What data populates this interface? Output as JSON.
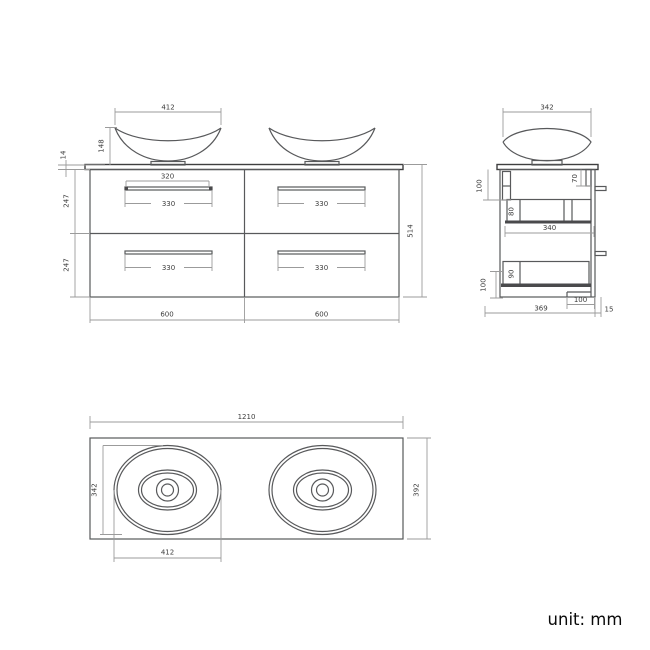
{
  "front_view": {
    "basin_width": "412",
    "basin_height": "148",
    "countertop_thickness": "14",
    "drawer_row_top_height": "247",
    "drawer_row_bottom_height": "247",
    "total_height": "514",
    "left_cabinet_width": "600",
    "right_cabinet_width": "600",
    "handle_span": "320",
    "handle_width_tl": "330",
    "handle_width_tr": "330",
    "handle_width_bl": "330",
    "handle_width_br": "330"
  },
  "side_view": {
    "basin_depth": "342",
    "top_bracket_height": "100",
    "back_bracket_height": "70",
    "upper_drawer_side_height": "80",
    "internal_depth": "340",
    "lower_drawer_side_height": "90",
    "bottom_bracket_height": "100",
    "recess_depth": "100",
    "cabinet_depth": "369",
    "back_offset": "15"
  },
  "plan_view": {
    "total_width": "1210",
    "basin_depth": "342",
    "countertop_depth": "392",
    "basin_width": "412"
  },
  "footer": {
    "unit_label": "unit: mm"
  },
  "colors": {
    "object_line": "#58595b",
    "dimension_line": "#9b9b9b",
    "text": "#3d3d3d",
    "background": "#ffffff"
  }
}
